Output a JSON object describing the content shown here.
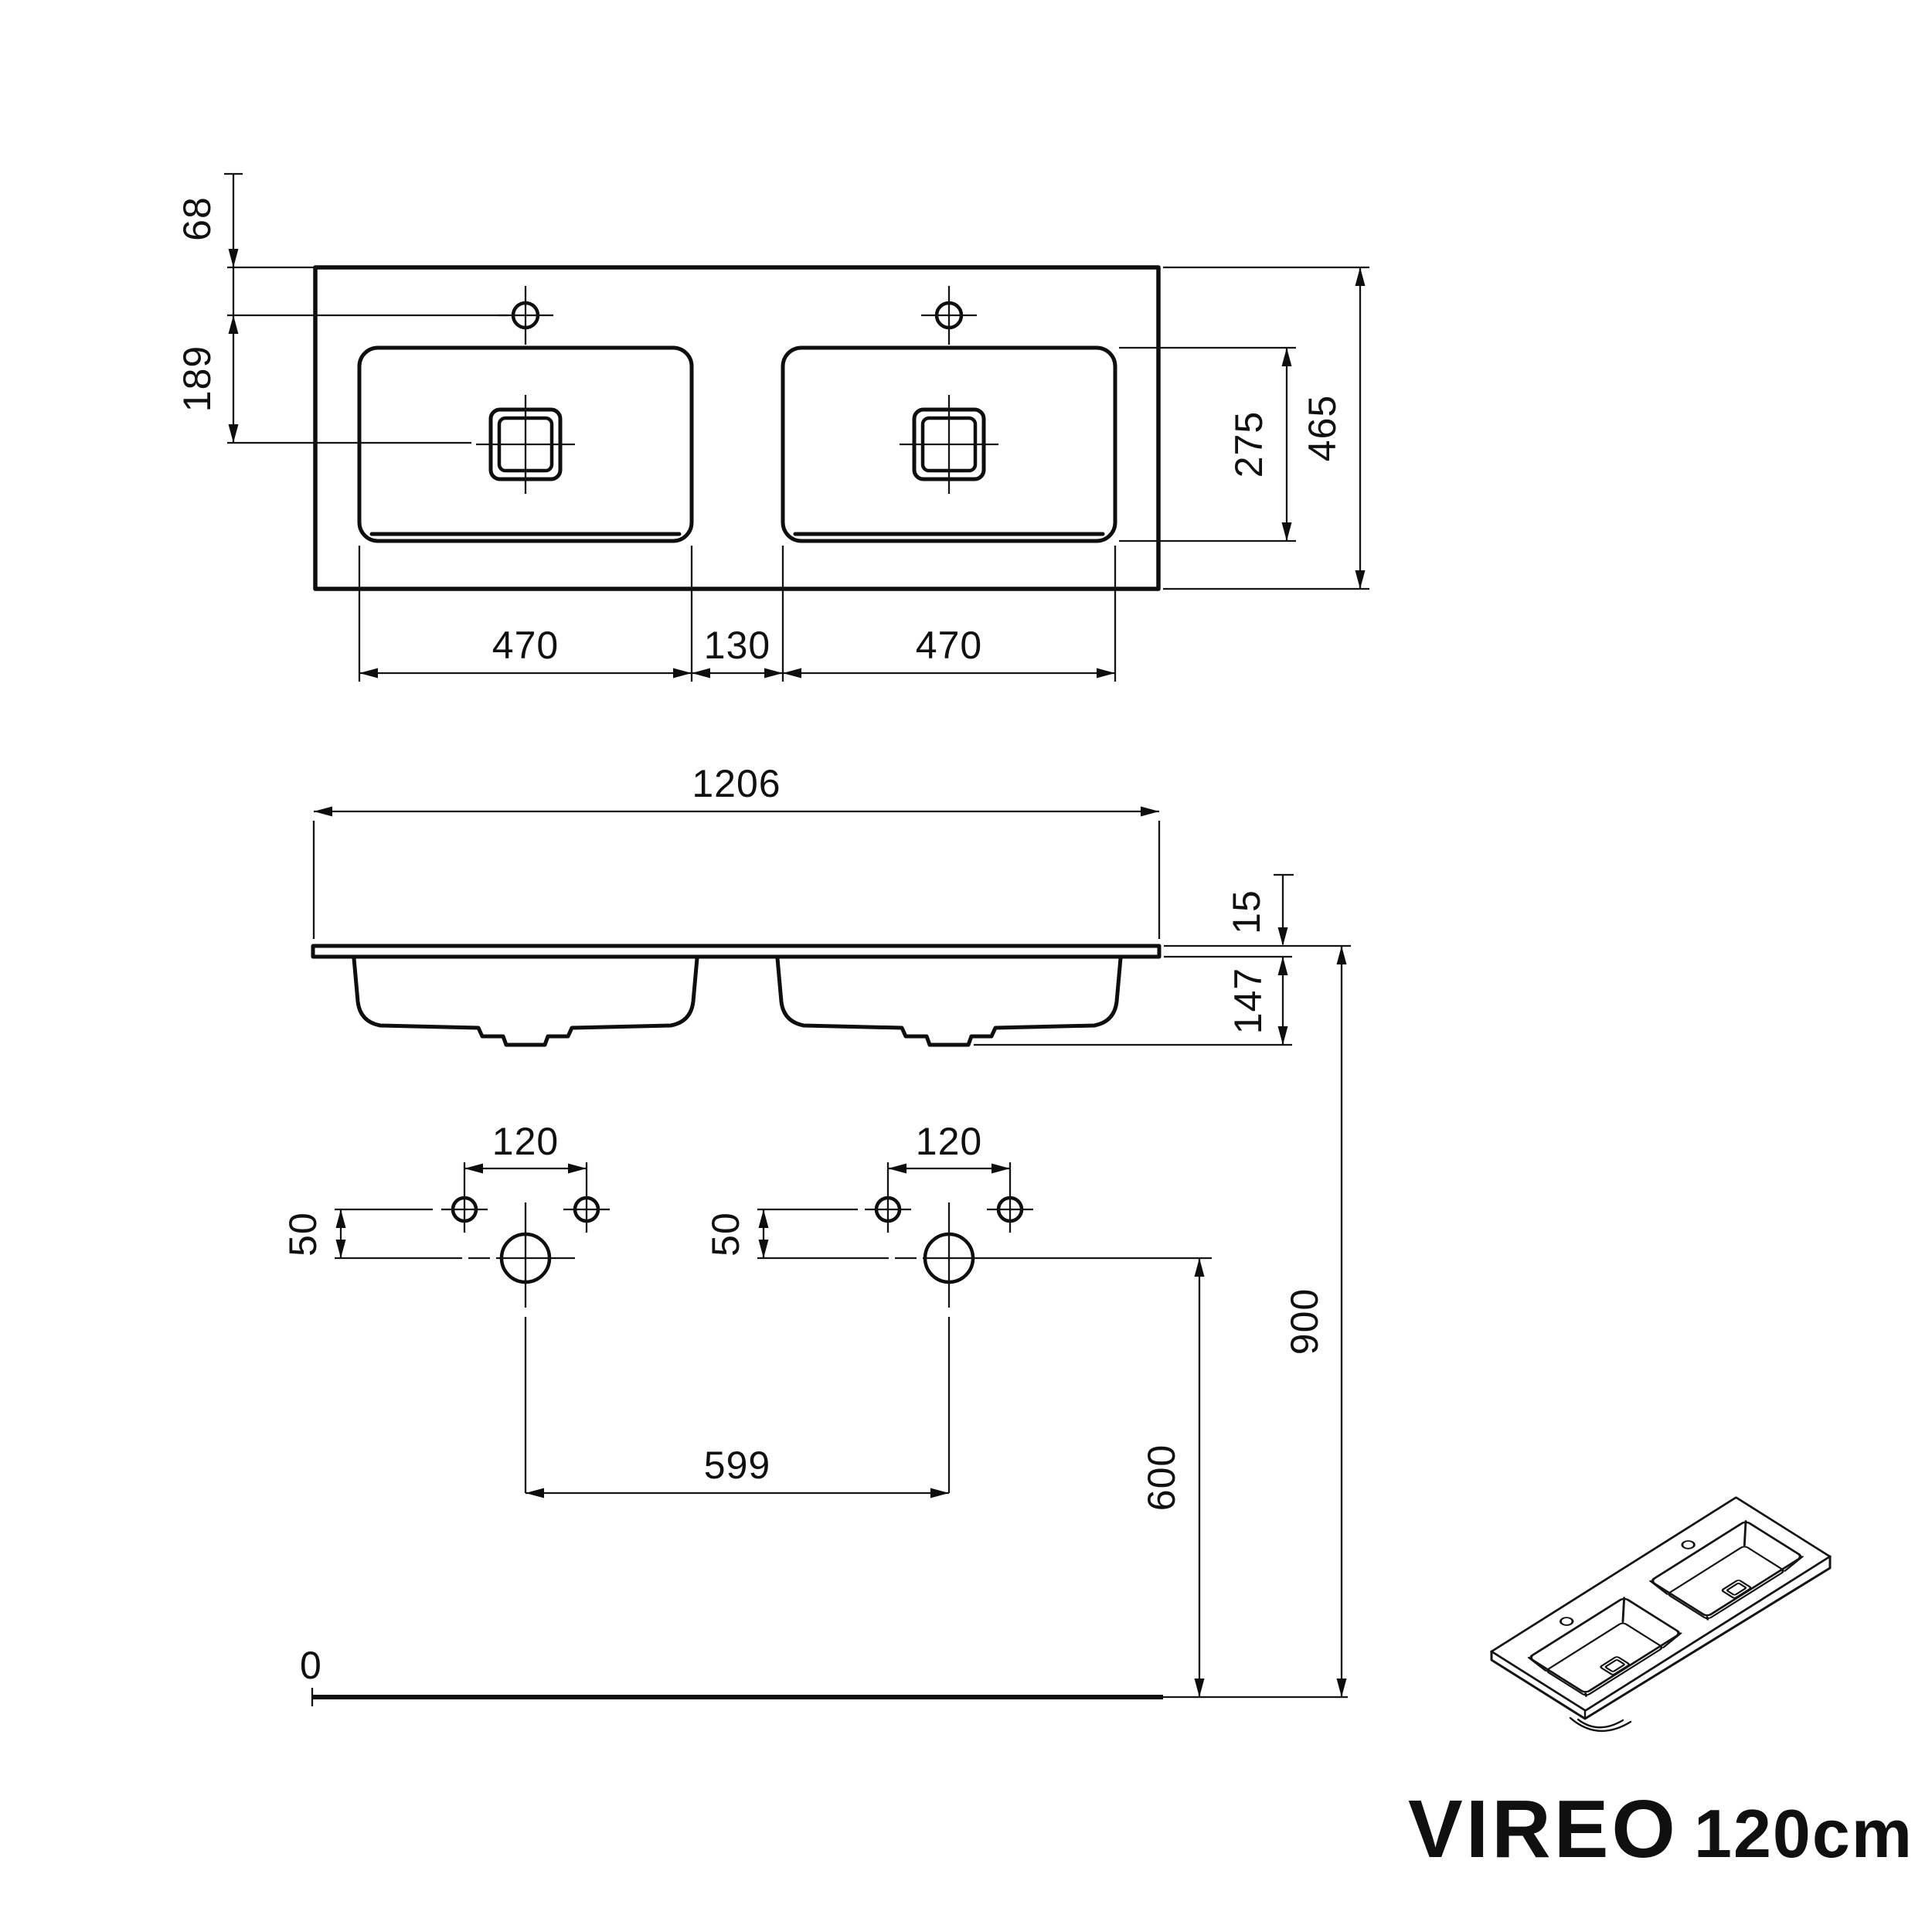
{
  "title": {
    "model": "VIREO",
    "variant": "120cm"
  },
  "top_view": {
    "edge_to_taphole": "68",
    "taphole_to_drain": "189",
    "left_basin_width": "470",
    "basin_gap": "130",
    "right_basin_width": "470",
    "basin_depth": "275",
    "total_depth": "465"
  },
  "front_view": {
    "total_width": "1206",
    "countertop_thickness": "15",
    "basin_height": "147"
  },
  "drill_template": {
    "taphole_spacing_left": "120",
    "taphole_spacing_right": "120",
    "taphole_offset_left": "50",
    "taphole_offset_right": "50",
    "drain_spacing": "599",
    "drain_height": "600",
    "top_height": "900",
    "floor_level": "0"
  }
}
